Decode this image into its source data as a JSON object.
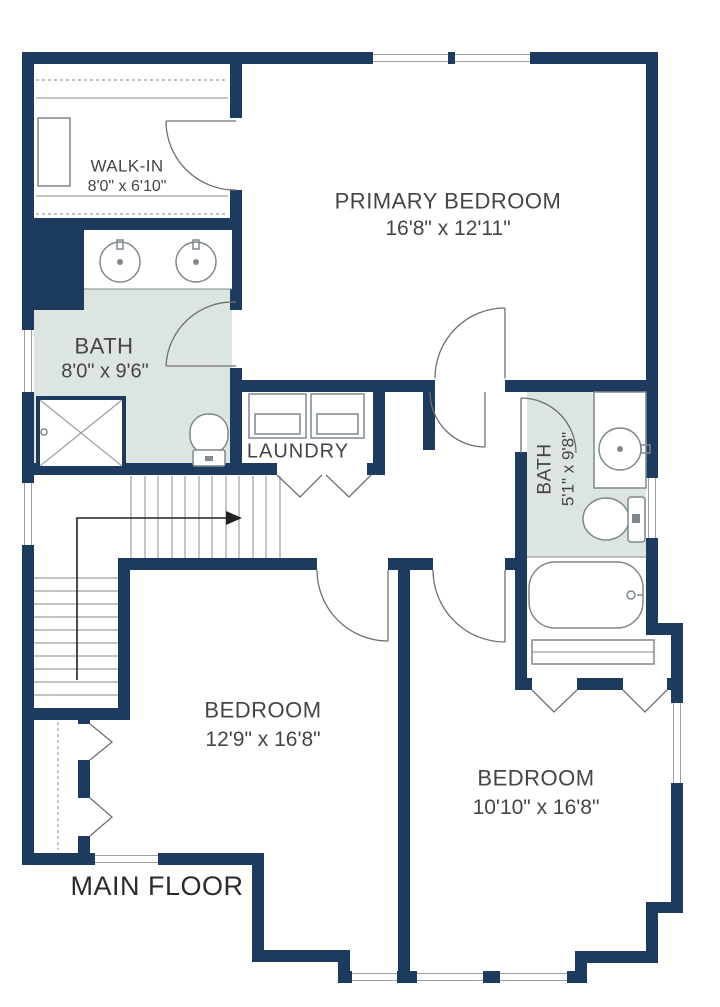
{
  "floor_plan": {
    "title": "MAIN FLOOR",
    "rooms": [
      {
        "id": "walk_in",
        "name": "WALK-IN",
        "dimensions": "8'0\" x 6'10\""
      },
      {
        "id": "primary_bedroom",
        "name": "PRIMARY BEDROOM",
        "dimensions": "16'8\" x 12'11\""
      },
      {
        "id": "bath_ensuite",
        "name": "BATH",
        "dimensions": "8'0\" x 9'6\""
      },
      {
        "id": "laundry",
        "name": "LAUNDRY",
        "dimensions": ""
      },
      {
        "id": "bath_hall",
        "name": "BATH",
        "dimensions": "5'1\" x 9'8\""
      },
      {
        "id": "bedroom_left",
        "name": "BEDROOM",
        "dimensions": "12'9\" x 16'8\""
      },
      {
        "id": "bedroom_right",
        "name": "BEDROOM",
        "dimensions": "10'10\" x 16'8\""
      }
    ],
    "colors": {
      "wall": "#1d3a5f",
      "bath_fill": "#dde5e0",
      "fixture_line": "#7e8890",
      "text": "#454545",
      "title_text": "#2b2b2b",
      "background": "#ffffff"
    }
  }
}
